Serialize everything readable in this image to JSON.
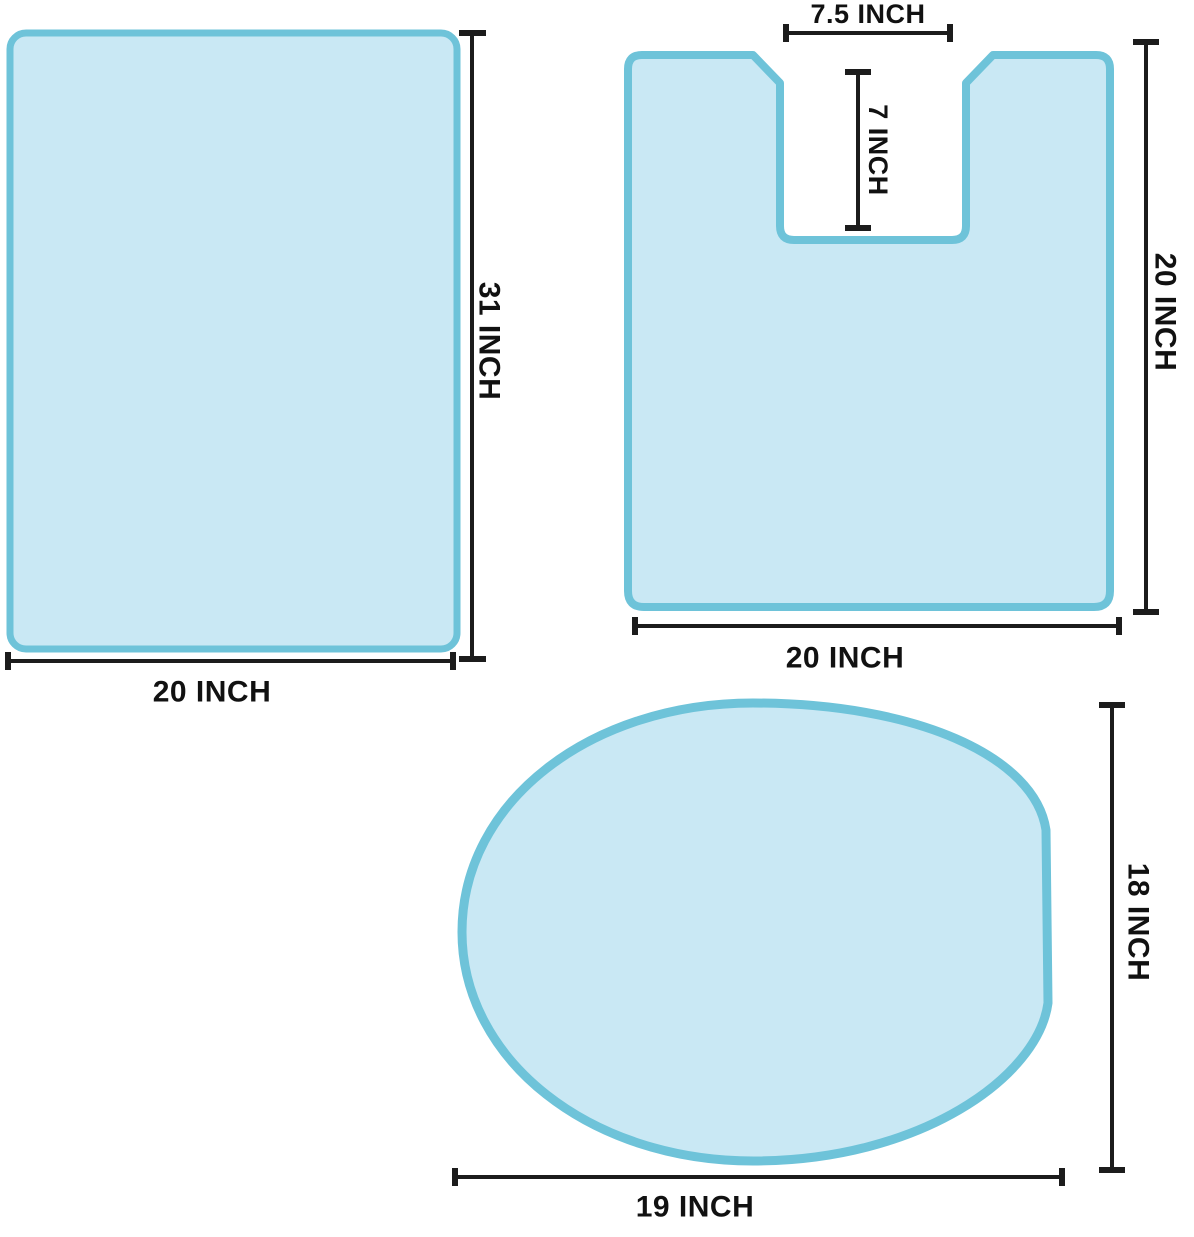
{
  "diagram_title": "3-piece bathroom rug set dimensions",
  "colors": {
    "rug_fill": "#c9e8f4",
    "rug_stroke": "#6ec3d9",
    "dimension_line": "#1c1c1c",
    "label_text": "#111111",
    "background": "#ffffff"
  },
  "bath_mat": {
    "width_label": "20 INCH",
    "height_label": "31 INCH"
  },
  "contour_rug": {
    "cutout_width_label": "7.5 INCH",
    "cutout_depth_label": "7 INCH",
    "height_label": "20 INCH",
    "width_label": "20 INCH"
  },
  "lid_cover": {
    "width_label": "19 INCH",
    "height_label": "18 INCH"
  }
}
